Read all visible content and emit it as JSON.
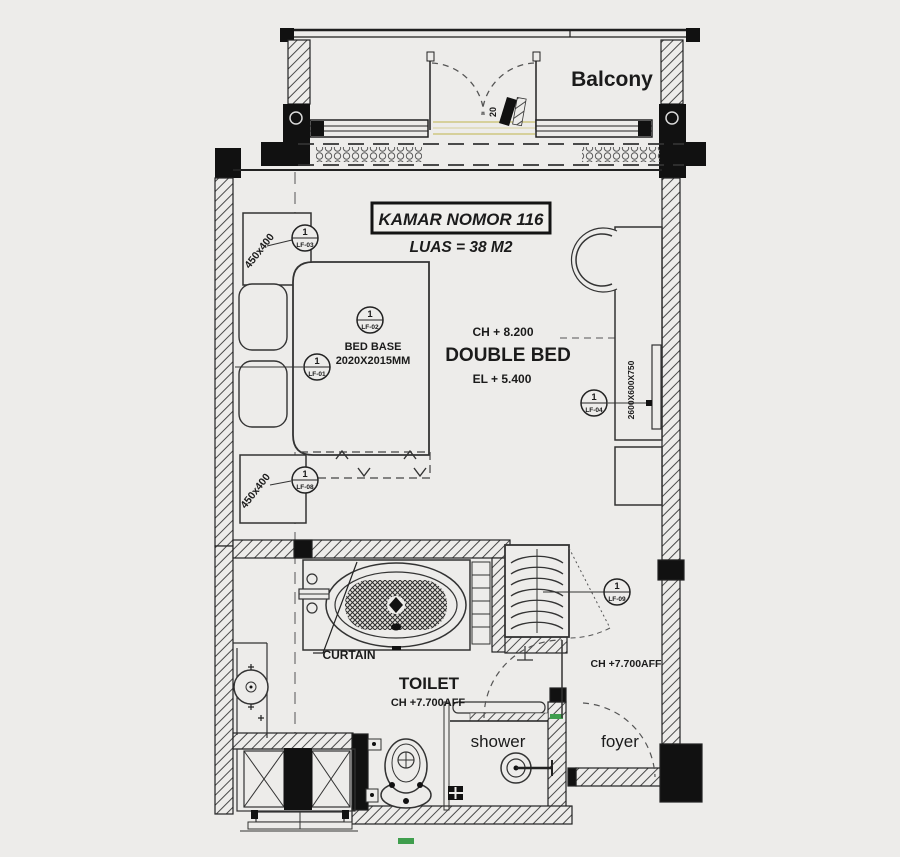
{
  "plan": {
    "title": "KAMAR NOMOR 116",
    "area_label": "LUAS = 38 M2",
    "room_labels": {
      "balcony": "Balcony",
      "double_bed": "DOUBLE BED",
      "toilet": "TOILET",
      "shower": "shower",
      "foyer": "foyer"
    },
    "annotations": {
      "ceiling_bedroom": "CH + 8.200",
      "elevation_bedroom": "EL + 5.400",
      "bed_base_line1": "BED BASE",
      "bed_base_line2": "2020X2015MM",
      "nightstand_top_dim": "450x400",
      "nightstand_bottom_dim": "450x400",
      "curtain": "CURTAIN",
      "ceiling_toilet": "CH +7.700AFF",
      "ceiling_foyer": "CH +7.700AFF",
      "desk_dim_rotated": "2600X600X750",
      "balcony_door_mark": "20"
    },
    "markers": {
      "lf01": {
        "num": "1",
        "id": "LF-01"
      },
      "lf02": {
        "num": "1",
        "id": "LF-02"
      },
      "lf03": {
        "num": "1",
        "id": "LF-03"
      },
      "lf04": {
        "num": "1",
        "id": "LF-04"
      },
      "lf08": {
        "num": "1",
        "id": "LF-08"
      },
      "lf09": {
        "num": "1",
        "id": "LF-09"
      }
    },
    "colors": {
      "background": "#edecea",
      "line": "#1f1f1f",
      "sill_accent": "#d6d09b",
      "green_accent": "#3f9e4d"
    }
  }
}
